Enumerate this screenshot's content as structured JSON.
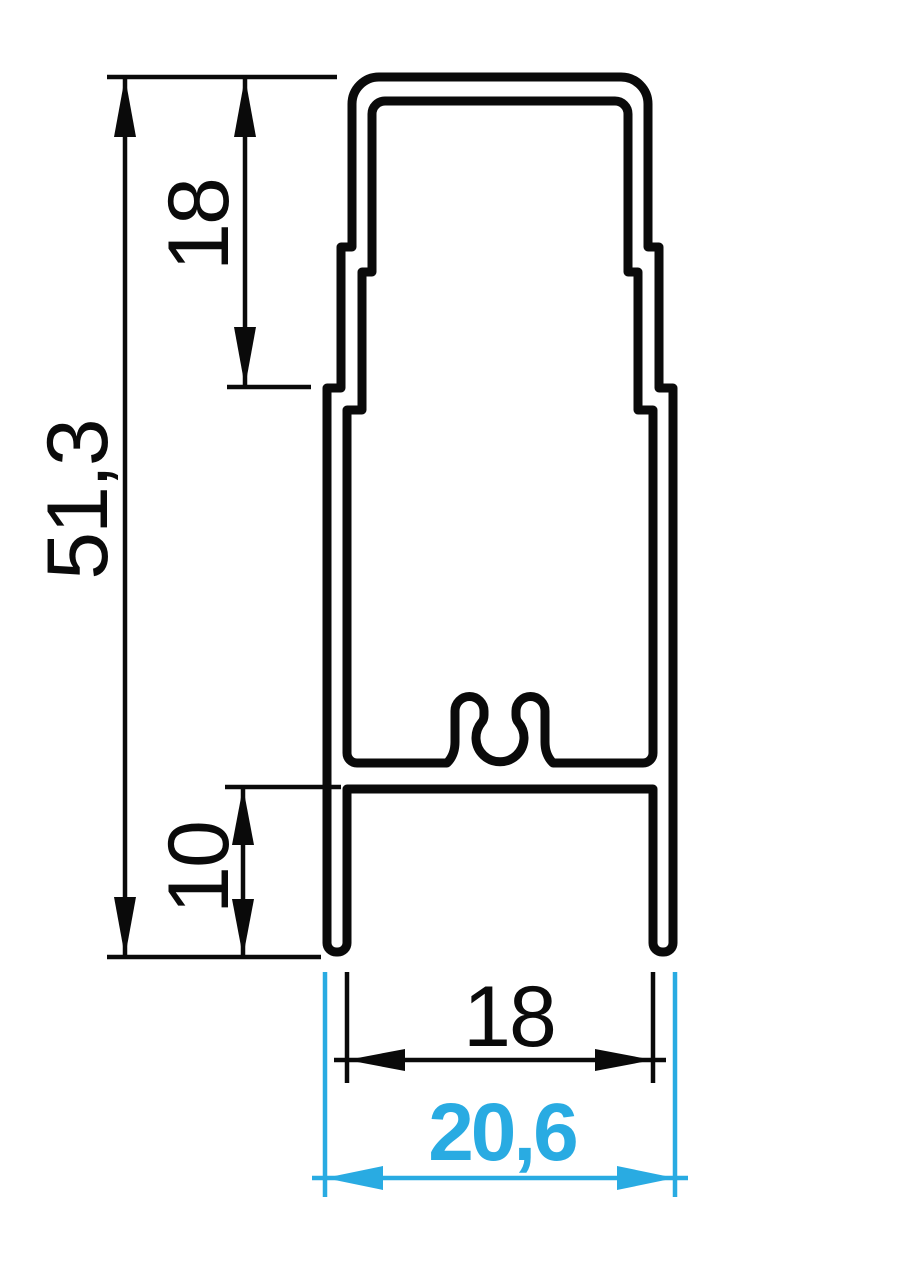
{
  "drawing": {
    "type": "technical-profile-cross-section",
    "units": "mm",
    "background_color": "#ffffff",
    "line_color": "#0a0a0a",
    "accent_color": "#29abe2",
    "dimensions": [
      {
        "id": "overall-height",
        "label": "51,3",
        "orientation": "vertical",
        "style": "standard",
        "color": "#0a0a0a"
      },
      {
        "id": "top-section-height",
        "label": "18",
        "orientation": "vertical",
        "style": "standard",
        "color": "#0a0a0a"
      },
      {
        "id": "leg-depth",
        "label": "10",
        "orientation": "vertical",
        "style": "standard",
        "color": "#0a0a0a"
      },
      {
        "id": "inner-leg-width",
        "label": "18",
        "orientation": "horizontal",
        "style": "standard",
        "color": "#0a0a0a"
      },
      {
        "id": "overall-width",
        "label": "20,6",
        "orientation": "horizontal",
        "style": "highlighted",
        "color": "#29abe2"
      }
    ]
  }
}
